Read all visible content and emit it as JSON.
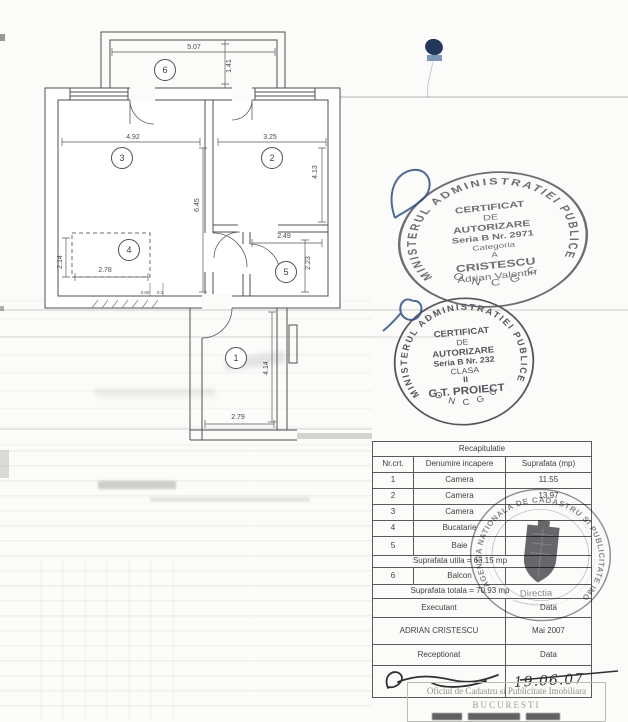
{
  "plan": {
    "rooms": {
      "r1": "1",
      "r2": "2",
      "r3": "3",
      "r4": "4",
      "r5": "5",
      "r6": "6"
    },
    "dims": {
      "balcony_w": "5.07",
      "balcony_d": "1.41",
      "room3_w": "4.92",
      "room2_w": "3.25",
      "room2_h": "4.13",
      "room3_h": "6.45",
      "bath_w": "2.49",
      "bath_h": "2.23",
      "kitchen_h": "2.14",
      "kitchen_w": "2.78",
      "hall_h": "4.14",
      "hall_w": "2.79",
      "tiny_a": "0.60",
      "tiny_b": "0.2"
    }
  },
  "stamps": {
    "s1": {
      "ring": "MINISTERUL ADMINISTRATIEI PUBLICE",
      "bottom": "O N C G C",
      "l1": "CERTIFICAT",
      "l2": "DE",
      "l3": "AUTORIZARE",
      "l4": "Seria B Nr. 2971",
      "l5": "Categoria",
      "l6": "A",
      "l7": "CRISTESCU",
      "l8": "Adrian Valentin"
    },
    "s2": {
      "ring": "MINISTERUL ADMINISTRATIEI PUBLICE",
      "bottom": "O N C G C",
      "l1": "CERTIFICAT",
      "l2": "DE",
      "l3": "AUTORIZARE",
      "l4": "Seria B Nr. 232",
      "l5": "CLASA",
      "l6": "II",
      "l7": "G.T. PROIECT"
    },
    "s3": {
      "ring": "AGENTIA NATIONALA DE CADASTRU SI PUBLICITATE IMOBILIARA",
      "center": "Directia"
    }
  },
  "table": {
    "title": "Recapitulatie",
    "col1": "Nr.crt.",
    "col2": "Denumire incapere",
    "col3": "Suprafata (mp)",
    "rows": [
      {
        "nr": "1",
        "name": "Camera",
        "area": "11.55"
      },
      {
        "nr": "2",
        "name": "Camera",
        "area": "13.97"
      },
      {
        "nr": "3",
        "name": "Camera",
        "area": ""
      },
      {
        "nr": "4",
        "name": "Bucatarie",
        "area": ""
      },
      {
        "nr": "5",
        "name": "Baie",
        "area": ""
      }
    ],
    "utila": "Suprafata utila = 63.15 mp",
    "balcon": {
      "nr": "6",
      "name": "Balcon",
      "area": ""
    },
    "totala": "Suprafata totala = 70.93 mp",
    "executant": "Executant",
    "data1": "Data",
    "executant_name": "ADRIAN CRISTESCU",
    "executant_data": "Mai 2007",
    "receptionat": "Receptionat",
    "data2": "Data",
    "receptionat_data": "19.06.07"
  },
  "footer": {
    "line1": "Oficiul de Cadastru si Publicitate Imobiliara",
    "line2": "BUCURESTI"
  }
}
